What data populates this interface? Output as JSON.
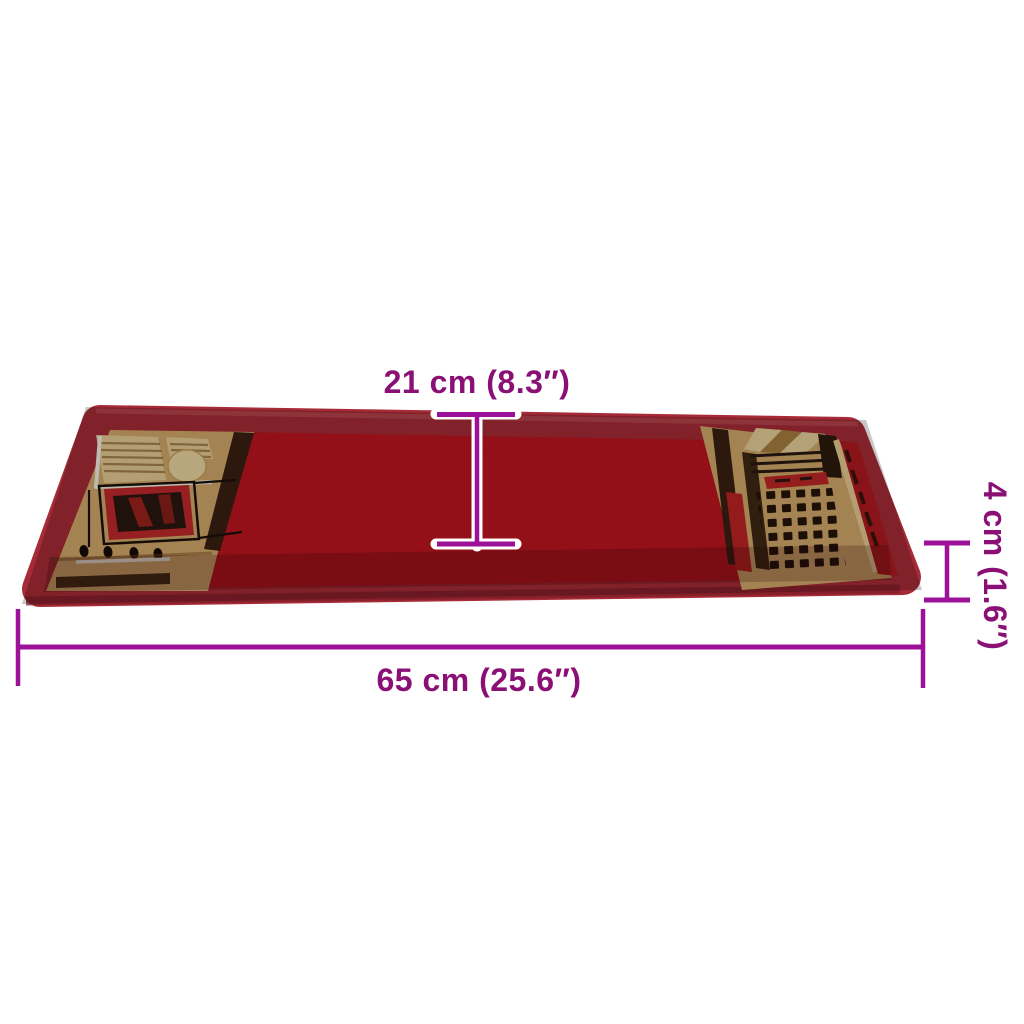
{
  "figure": {
    "subject": "Red stair tread mat with beige geometric pattern panels, perspective view with measurement markers"
  },
  "dimensions": {
    "depth": {
      "label": "21 cm (8.3″)",
      "value_cm": "21",
      "value_inch": "8.3"
    },
    "thickness": {
      "label": "4 cm (1.6″)",
      "value_cm": "4",
      "value_inch": "1.6"
    },
    "width": {
      "label": "65 cm (25.6″)",
      "value_cm": "65",
      "value_inch": "25.6"
    }
  },
  "colors": {
    "dimension_text": "#8A1076",
    "dimension_line": "#9C109A",
    "halo_white": "#FFFFFF",
    "binding_red": "#A62B36",
    "field_red": "#BE1520",
    "front_shade": "rgba(40,0,5,0.22)",
    "beige": "#D4A96B",
    "beige_light": "#E7CC96",
    "dark_brown": "#3B2012",
    "accent_red": "#C1292B",
    "background": "#FFFFFF"
  }
}
